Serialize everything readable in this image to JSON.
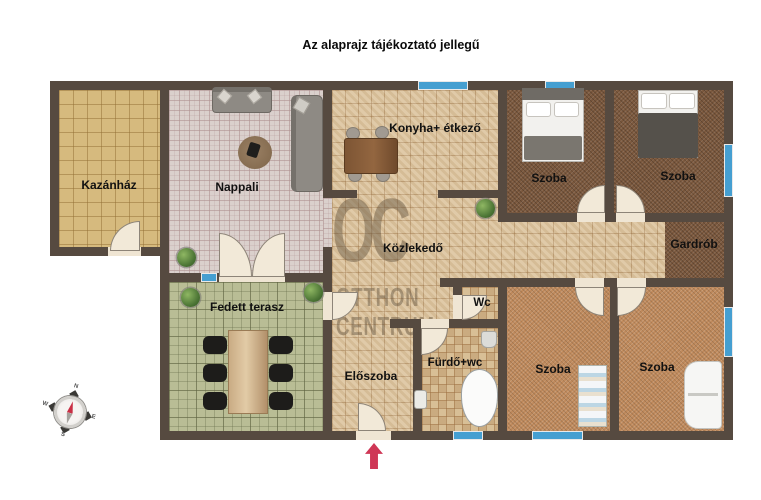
{
  "title": "Az alaprajz tájékoztató jellegű",
  "watermark": {
    "initials": "OC",
    "line1": "OTTHON",
    "line2": "CENTRUM"
  },
  "rooms": {
    "kazanhaz": "Kazánház",
    "nappali": "Nappali",
    "konyha": "Konyha+ étkező",
    "szoba_felso_1": "Szoba",
    "szoba_felso_2": "Szoba",
    "gardrob": "Gardrób",
    "kozlekedo": "Közlekedő",
    "wc": "Wc",
    "furdo": "Fürdő+wc",
    "eloszoba": "Előszoba",
    "fedett_terasz": "Fedett terasz",
    "szoba_also_1": "Szoba",
    "szoba_also_2": "Szoba"
  },
  "compass": {
    "north": "N",
    "east": "E",
    "south": "S",
    "west": "W"
  },
  "entrance": {
    "marker": "entrance-arrow",
    "color": "#cf3756"
  },
  "colors": {
    "wall": "#564a40",
    "window": "#459fd1",
    "floor_beige": "#dcc49e",
    "floor_grey": "#dad0cc",
    "floor_gold": "#d6ba7e",
    "floor_green": "#b9bd95",
    "carpet_dark": "#7b583d",
    "carpet_tan": "#c08a5c",
    "door": "#f2e9d8"
  }
}
